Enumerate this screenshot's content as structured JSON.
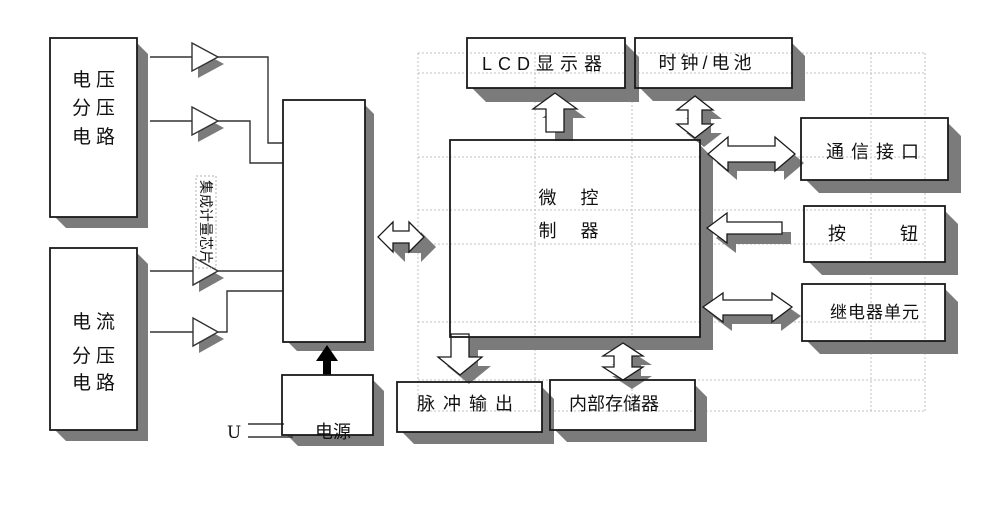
{
  "boxes": {
    "voltage_divider": {
      "lines": [
        "电压",
        "分压",
        "电路"
      ]
    },
    "current_divider": {
      "lines": [
        "电流",
        "分压",
        "电路"
      ]
    },
    "metering_chip": {
      "label": "集成计量芯片"
    },
    "microcontroller": {
      "lines": [
        "微　控",
        "制　器"
      ]
    },
    "lcd_display": {
      "label": "LCD显示器"
    },
    "clock_battery": {
      "label": "时钟/电池"
    },
    "comm_interface": {
      "label": "通信接口"
    },
    "button": {
      "label": "按　　　钮"
    },
    "relay_unit": {
      "label": "继电器单元"
    },
    "pulse_output": {
      "label": "脉冲输出"
    },
    "internal_memory": {
      "label": "内部存储器"
    },
    "power_supply": {
      "label": "电源"
    },
    "voltage_input": {
      "label": "U"
    }
  },
  "colors": {
    "box_shadow": "#7b7b7b",
    "line": "#1a1a1a",
    "grid_dash": "#c2c2c2",
    "background": "#ffffff"
  }
}
